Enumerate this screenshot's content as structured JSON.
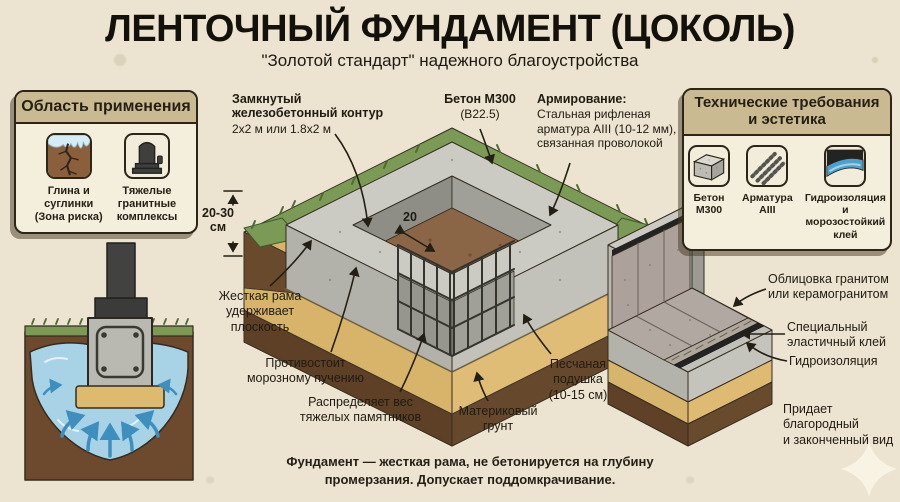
{
  "header": {
    "title": "ЛЕНТОЧНЫЙ ФУНДАМЕНТ (ЦОКОЛЬ)",
    "subtitle": "\"Золотой стандарт\" надежного благоустройства"
  },
  "left_panel": {
    "title": "Область применения",
    "items": [
      {
        "icon": "cracked-clay-frost-icon",
        "label": "Глина и\nсуглинки\n(Зона риска)"
      },
      {
        "icon": "granite-monument-icon",
        "label": "Тяжелые\nгранитные\nкомплексы"
      }
    ]
  },
  "right_panel": {
    "title": "Технические требования\nи эстетика",
    "items": [
      {
        "icon": "concrete-block-icon",
        "label": "Бетон\nМ300"
      },
      {
        "icon": "rebar-rods-icon",
        "label": "Арматура\nAIII"
      },
      {
        "icon": "waterproofing-layer-icon",
        "label": "Гидроизоляция\nи морозостойкий\nклей"
      }
    ]
  },
  "callouts": {
    "contour": {
      "title": "Замкнутый\nжелезобетонный контур",
      "sub": "2х2 м или 1.8х2 м"
    },
    "concrete": {
      "title": "Бетон М300",
      "sub": "(В22.5)"
    },
    "reinforcement": {
      "title": "Армирование:",
      "sub": "Стальная рифленая\nарматура AIII (10-12 мм),\nсвязанная проволокой"
    },
    "rigid_frame": "Жесткая рама\nудерживает\nплоскость",
    "frost": "Противостоит\nморозному пучению",
    "weight": "Распределяет вес\nтяжелых памятников",
    "sand_cushion": "Песчаная\nподушка\n(10-15 см)",
    "bedrock": "Материковый\nгрунт",
    "cladding": "Облицовка гранитом\nили керамогранитом",
    "glue": "Специальный\nэластичный клей",
    "waterproofing": "Гидроизоляция",
    "noble": "Придает\nблагородный\nи законченный вид"
  },
  "dimensions": {
    "height_above_ground": "20-30\nсм",
    "wall_width": "20"
  },
  "footer": {
    "note": "Фундамент — жесткая рама, не бетонируется на глубину\nпромерзания. Допускает поддомкрачивание."
  },
  "colors": {
    "background": "#ece4d1",
    "ink": "#241f14",
    "panel_header": "#c9ba92",
    "panel_body": "#f4eedd",
    "grass": "#7b9a55",
    "topsoil": "#6a4a2d",
    "sand": "#d8b56c",
    "deep_soil": "#5e4127",
    "concrete": "#c6c6be",
    "water": "#a8d2e6",
    "arrow_blue": "#3f8fbe"
  }
}
